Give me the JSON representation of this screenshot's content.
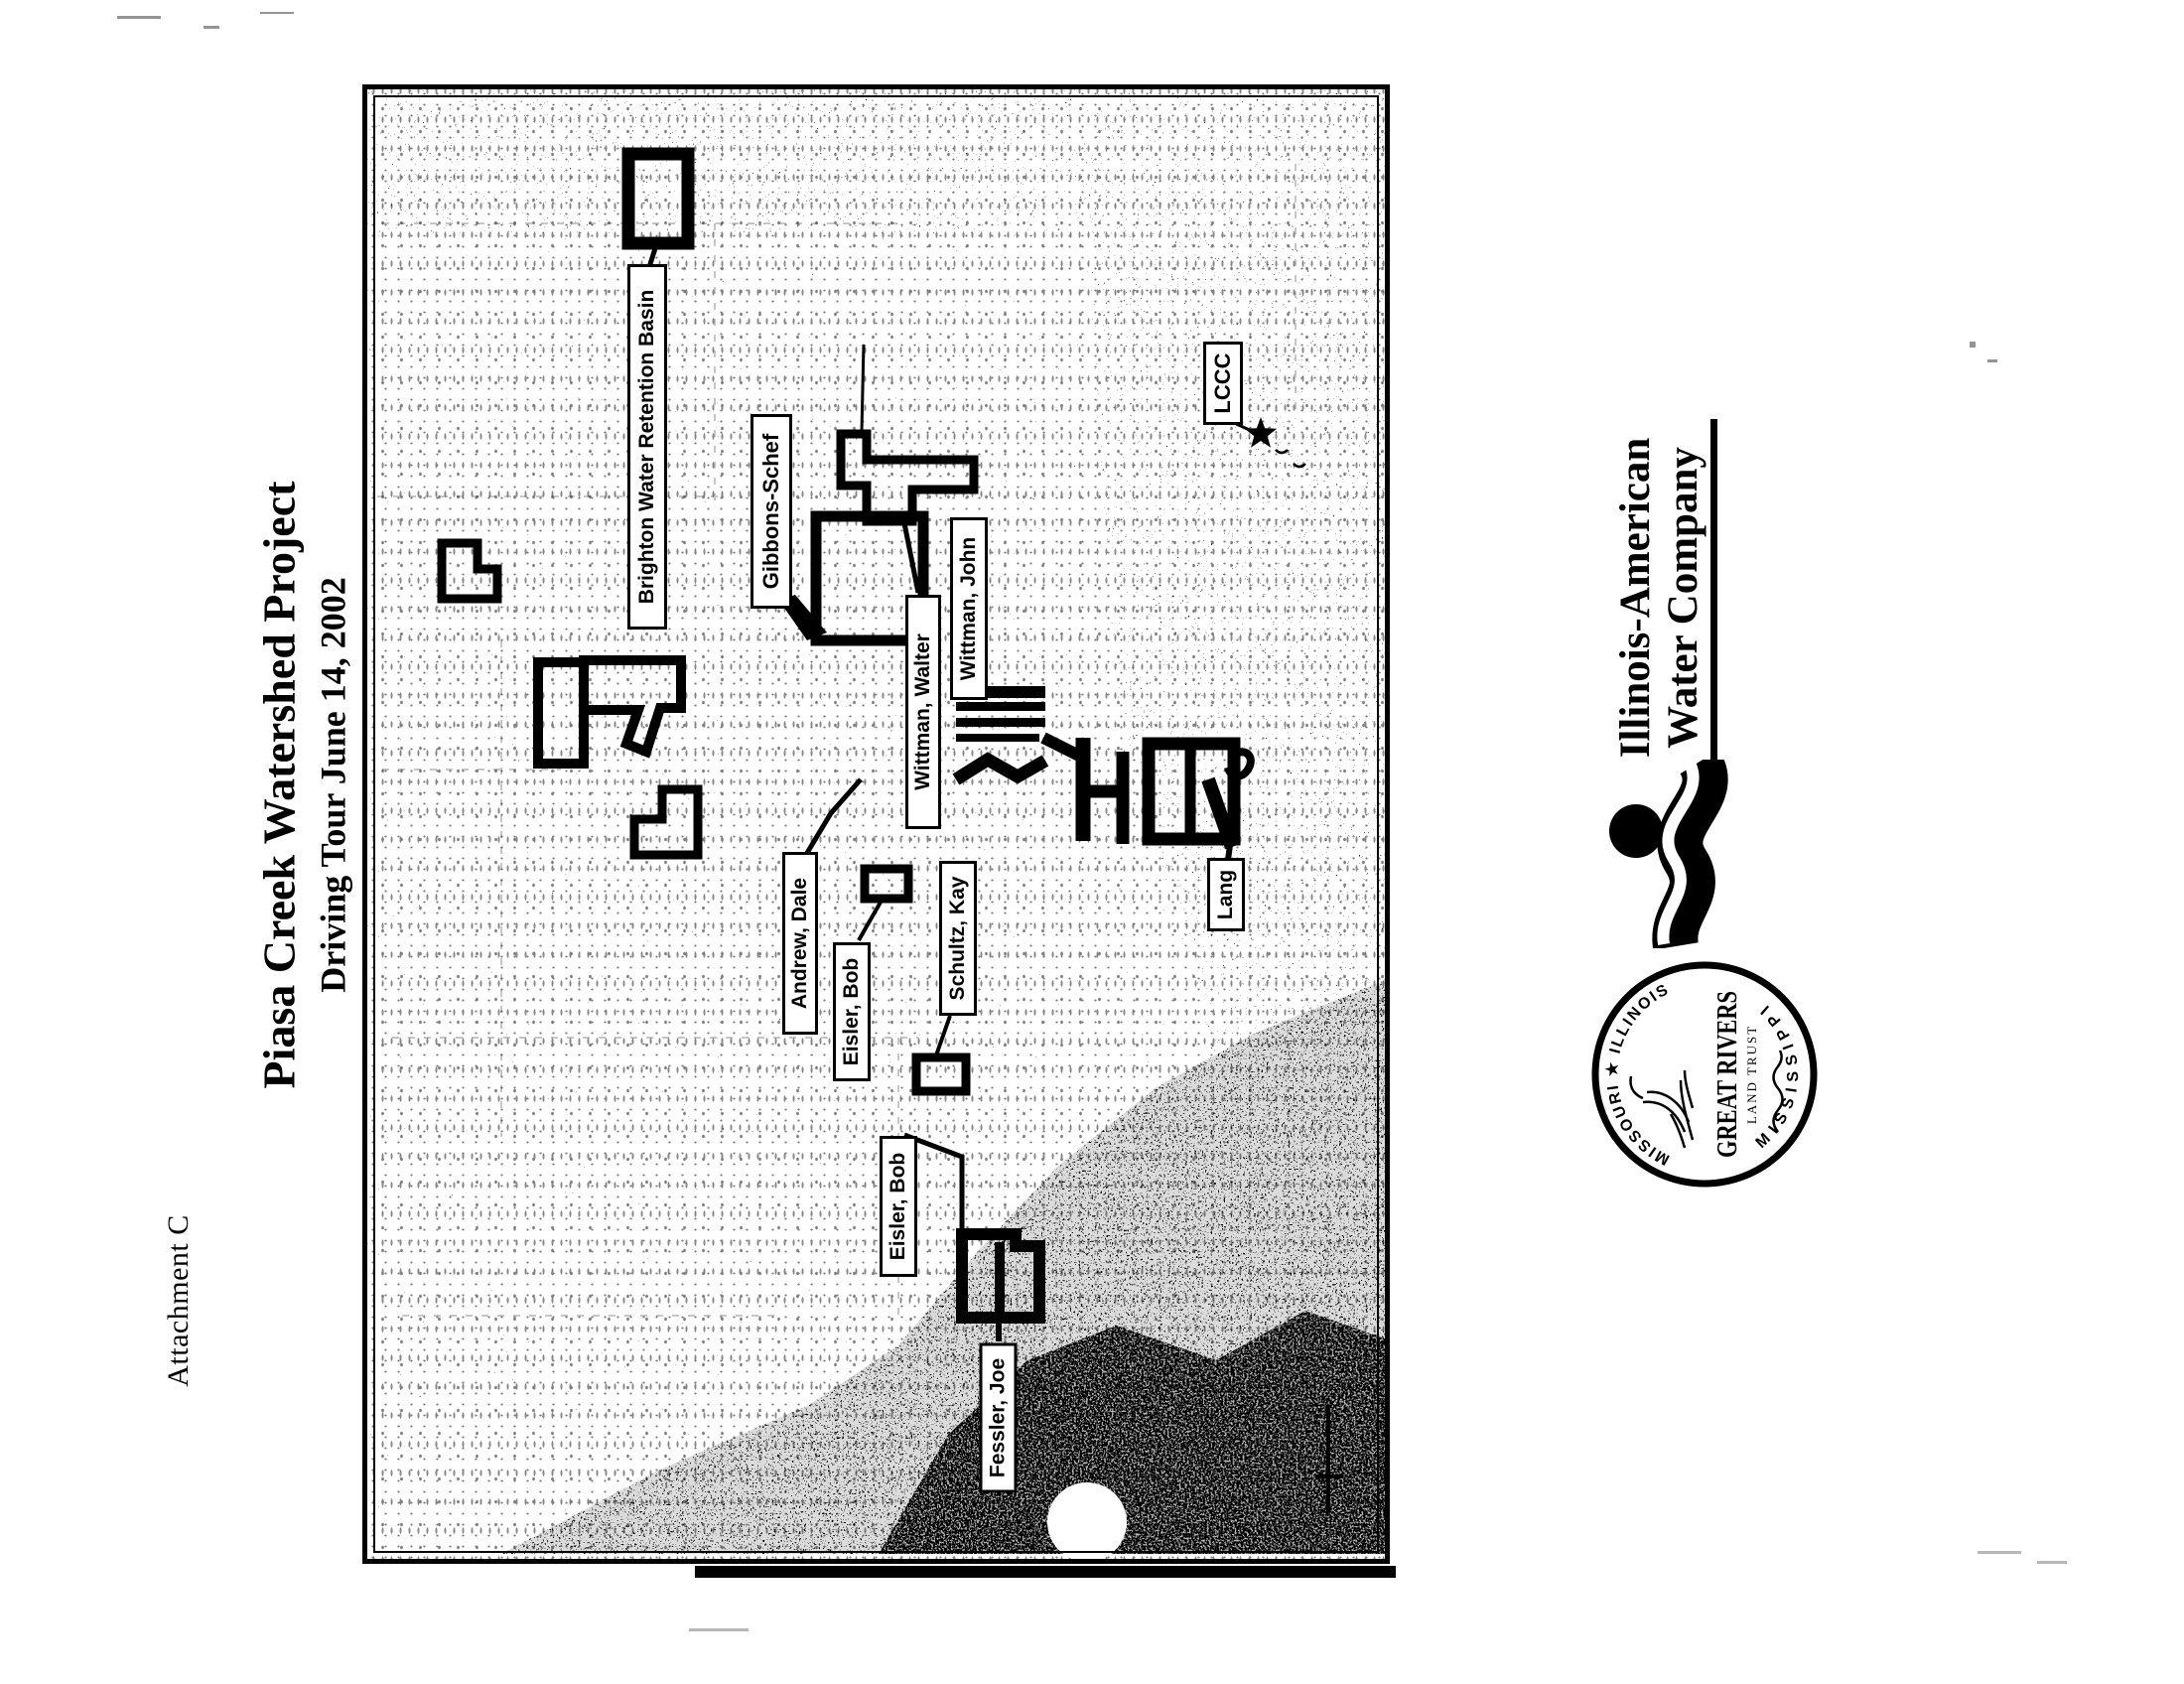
{
  "page": {
    "attachment_label": "Attachment C",
    "title": "Piasa Creek Watershed Project",
    "subtitle": "Driving Tour June 14, 2002"
  },
  "map": {
    "parcel_labels": [
      {
        "id": "brighton-water-retention-basin",
        "text": "Brighton Water Retention Basin"
      },
      {
        "id": "gibbons-schef",
        "text": "Gibbons-Schef"
      },
      {
        "id": "wittman-walter",
        "text": "Wittman, Walter"
      },
      {
        "id": "wittman-john",
        "text": "Wittman, John"
      },
      {
        "id": "lccc",
        "text": "LCCC"
      },
      {
        "id": "andrew-dale",
        "text": "Andrew, Dale"
      },
      {
        "id": "eisler-bob-1",
        "text": "Eisler, Bob"
      },
      {
        "id": "schultz-kay",
        "text": "Schultz, Kay"
      },
      {
        "id": "eisler-bob-2",
        "text": "Eisler, Bob"
      },
      {
        "id": "fessler-joe",
        "text": "Fessler, Joe"
      },
      {
        "id": "lang",
        "text": "Lang"
      }
    ]
  },
  "logos": {
    "water_company": {
      "line1": "Illinois-American",
      "line2": "Water Company"
    },
    "land_trust": {
      "ring_top": "MISSOURI ★ ILLINOIS",
      "ring_bottom": "MISSISSIPPI",
      "name": "GREAT RIVERS",
      "subtitle": "LAND TRUST"
    }
  },
  "colors": {
    "ink": "#000000",
    "paper": "#ffffff"
  }
}
